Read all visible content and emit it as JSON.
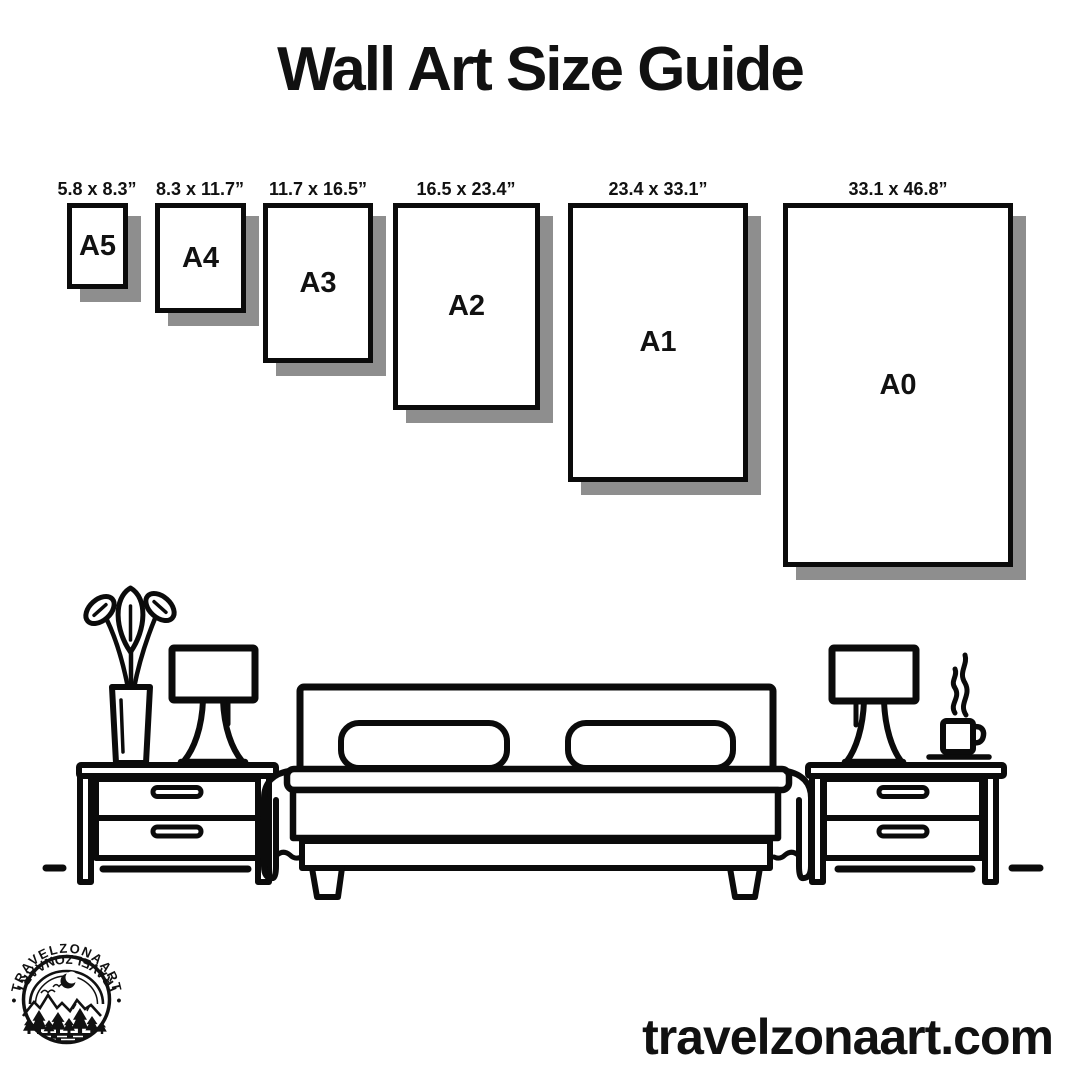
{
  "title": "Wall Art Size Guide",
  "website": "travelzonaart.com",
  "colors": {
    "ink": "#0b0b0b",
    "background": "#ffffff",
    "card_shadow": "#8e8e8e"
  },
  "size_guide": {
    "sizes": [
      {
        "label": "A5",
        "dimensions": "5.8 x 8.3”"
      },
      {
        "label": "A4",
        "dimensions": "8.3 x 11.7”"
      },
      {
        "label": "A3",
        "dimensions": "11.7 x 16.5”"
      },
      {
        "label": "A2",
        "dimensions": "16.5 x 23.4”"
      },
      {
        "label": "A1",
        "dimensions": "23.4 x 33.1”"
      },
      {
        "label": "A0",
        "dimensions": "33.1 x 46.8”"
      }
    ]
  },
  "logo": {
    "text_top": "TRAVELZONAART",
    "text_bottom": "TRAVELZONAART",
    "separator": "•"
  }
}
